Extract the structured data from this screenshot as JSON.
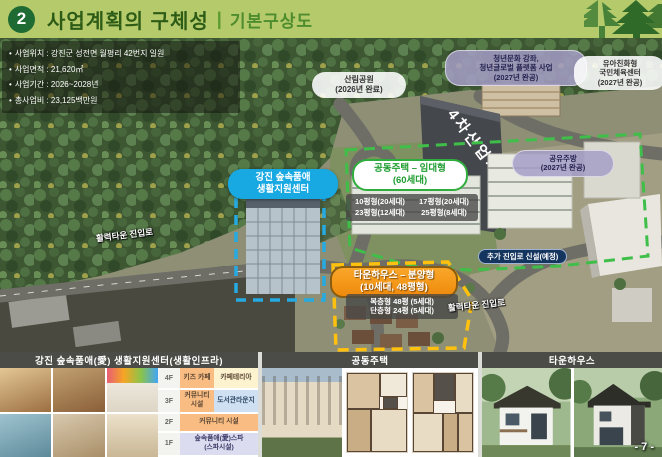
{
  "header": {
    "badge": "2",
    "title": "사업계획의 구체성",
    "divider": "|",
    "subtitle": "기본구상도"
  },
  "info_box": {
    "bullet": "•",
    "items": [
      "사업위치 : 강진군 성전면 월평리 42번지 일원",
      "사업면적 : 21,620㎡",
      "사업기간 : 2026~2028년",
      "총사업비 : 23,125백만원"
    ]
  },
  "map": {
    "forest_park": {
      "l1": "산림공원",
      "l2": "(2026년 완료)"
    },
    "youth_program": {
      "l1": "청년문화 강좌,",
      "l2": "청년글로벌 플랫폼 사업",
      "l3": "(2027년 완공)"
    },
    "child_sports": {
      "l1": "유아친화형",
      "l2": "국민체육센터",
      "l3": "(2027년 완공)"
    },
    "industry_center": {
      "label": "4차산업지원센터"
    },
    "shared_kitchen": {
      "l1": "공유주방",
      "l2": "(2027년 완공)"
    },
    "support_center": {
      "l1": "강진 숲속품애",
      "l2": "생활지원센터"
    },
    "apartment": {
      "l1": "공동주택 – 임대형",
      "l2": "(60세대)",
      "units": [
        "10평형(20세대)",
        "17평형(20세대)",
        "23평형(12세대)",
        "25평형(8세대)"
      ]
    },
    "new_road": {
      "label": "추가 진입로 신설(예정)"
    },
    "townhouse": {
      "l1": "타운하우스 – 분양형",
      "l2": "(10세대, 48평형)",
      "units": [
        "복층형 48평 (5세대)",
        "단층형 24평 (5세대)"
      ]
    },
    "road_left": {
      "label": "활력타운 진입로"
    },
    "road_right": {
      "label": "활력타운 진입로"
    }
  },
  "panels": {
    "infra": {
      "title": "강진 숲속품애(愛) 생활지원센터(생활인프라)",
      "floors": {
        "f4": {
          "label": "4F",
          "c1": "키즈 카페",
          "c2": "카페테리아"
        },
        "f3": {
          "label": "3F",
          "c1": "커뮤니티 시설",
          "c2": "도서관라운지"
        },
        "f2": {
          "label": "2F",
          "c1": "커뮤니티 시설"
        },
        "f1": {
          "label": "1F",
          "c1": "숲속품애(愛)스파",
          "c1b": "(스파시설)"
        }
      }
    },
    "apartment": {
      "title": "공동주택"
    },
    "townhouse": {
      "title": "타운하우스"
    }
  },
  "page": {
    "number": "- 7 -"
  },
  "colors": {
    "header_band": "#b5ca6b",
    "badge_green": "#1e6b33",
    "label_blue": "#18a8e2",
    "label_green": "#2fae3e",
    "label_orange": "#f59a1c",
    "dash_yellow": "#ffc10e"
  }
}
